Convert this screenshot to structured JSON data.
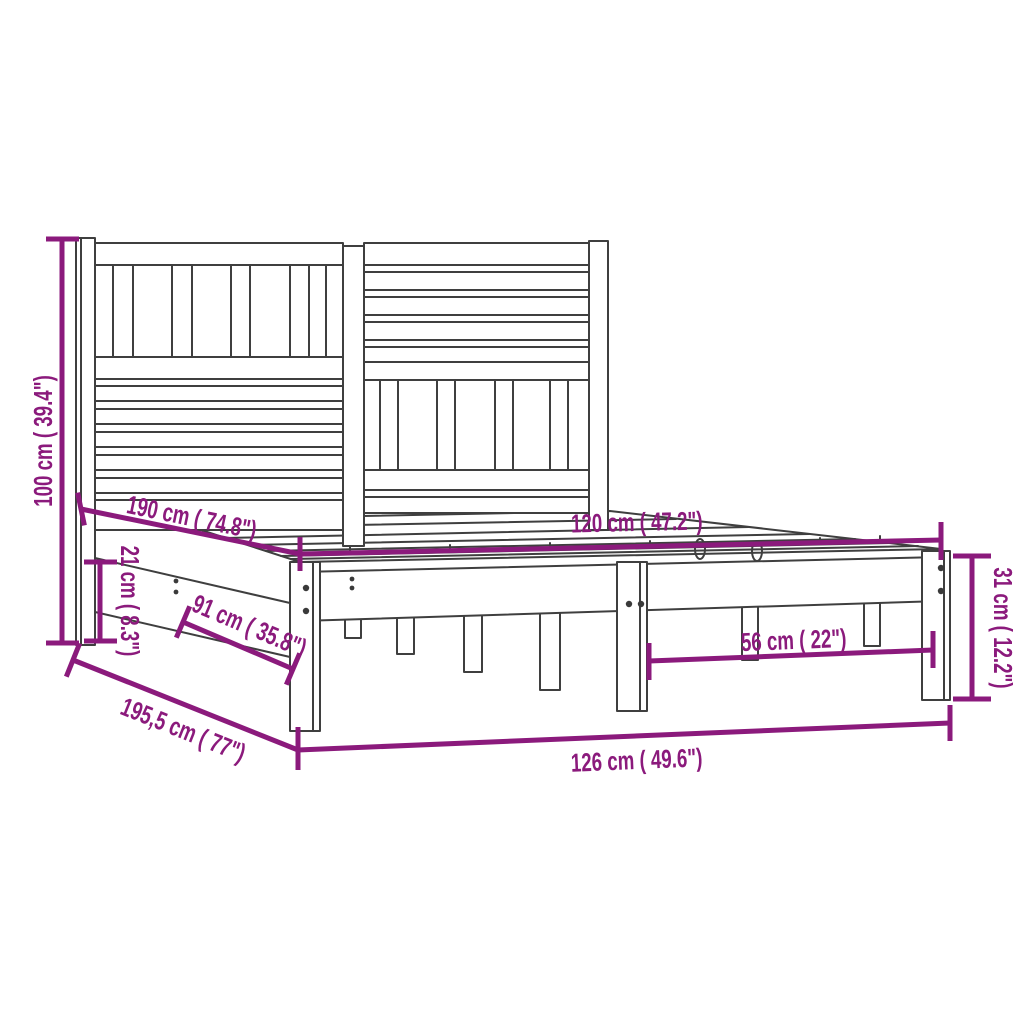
{
  "page": {
    "background_color": "#ffffff"
  },
  "diagram": {
    "subject": "Wooden bed frame with slatted headboard - technical dimension drawing",
    "style": {
      "drawing_line_color": "#3f3f3f",
      "dimension_color": "#8b1a7c",
      "background": "#ffffff"
    },
    "dimensions": [
      {
        "id": "total-height",
        "label": "100 cm ( 39.4\")",
        "cm": 100,
        "inch": 39.4,
        "placement": "left edge, vertical"
      },
      {
        "id": "inner-length",
        "label": "190 cm ( 74.8\")",
        "cm": 190,
        "inch": 74.8,
        "placement": "upper left, along bed length"
      },
      {
        "id": "inner-width",
        "label": "120 cm ( 47.2\")",
        "cm": 120,
        "inch": 47.2,
        "placement": "across mattress platform"
      },
      {
        "id": "left-rail-height",
        "label": "21 cm ( 8.3\")",
        "cm": 21,
        "inch": 8.3,
        "placement": "left side, vertical"
      },
      {
        "id": "support-span",
        "label": "91 cm ( 35.8\")",
        "cm": 91,
        "inch": 35.8,
        "placement": "lower left, along bed length"
      },
      {
        "id": "total-length",
        "label": "195,5 cm ( 77\")",
        "cm": 195.5,
        "inch": 77,
        "placement": "bottom left, along bed length"
      },
      {
        "id": "total-width",
        "label": "126 cm ( 49.6\")",
        "cm": 126,
        "inch": 49.6,
        "placement": "bottom, across foot end"
      },
      {
        "id": "leg-spacing",
        "label": "56 cm ( 22\")",
        "cm": 56,
        "inch": 22,
        "placement": "lower right, between legs"
      },
      {
        "id": "frame-height",
        "label": "31 cm ( 12.2\")",
        "cm": 31,
        "inch": 12.2,
        "placement": "right edge, vertical"
      }
    ]
  }
}
